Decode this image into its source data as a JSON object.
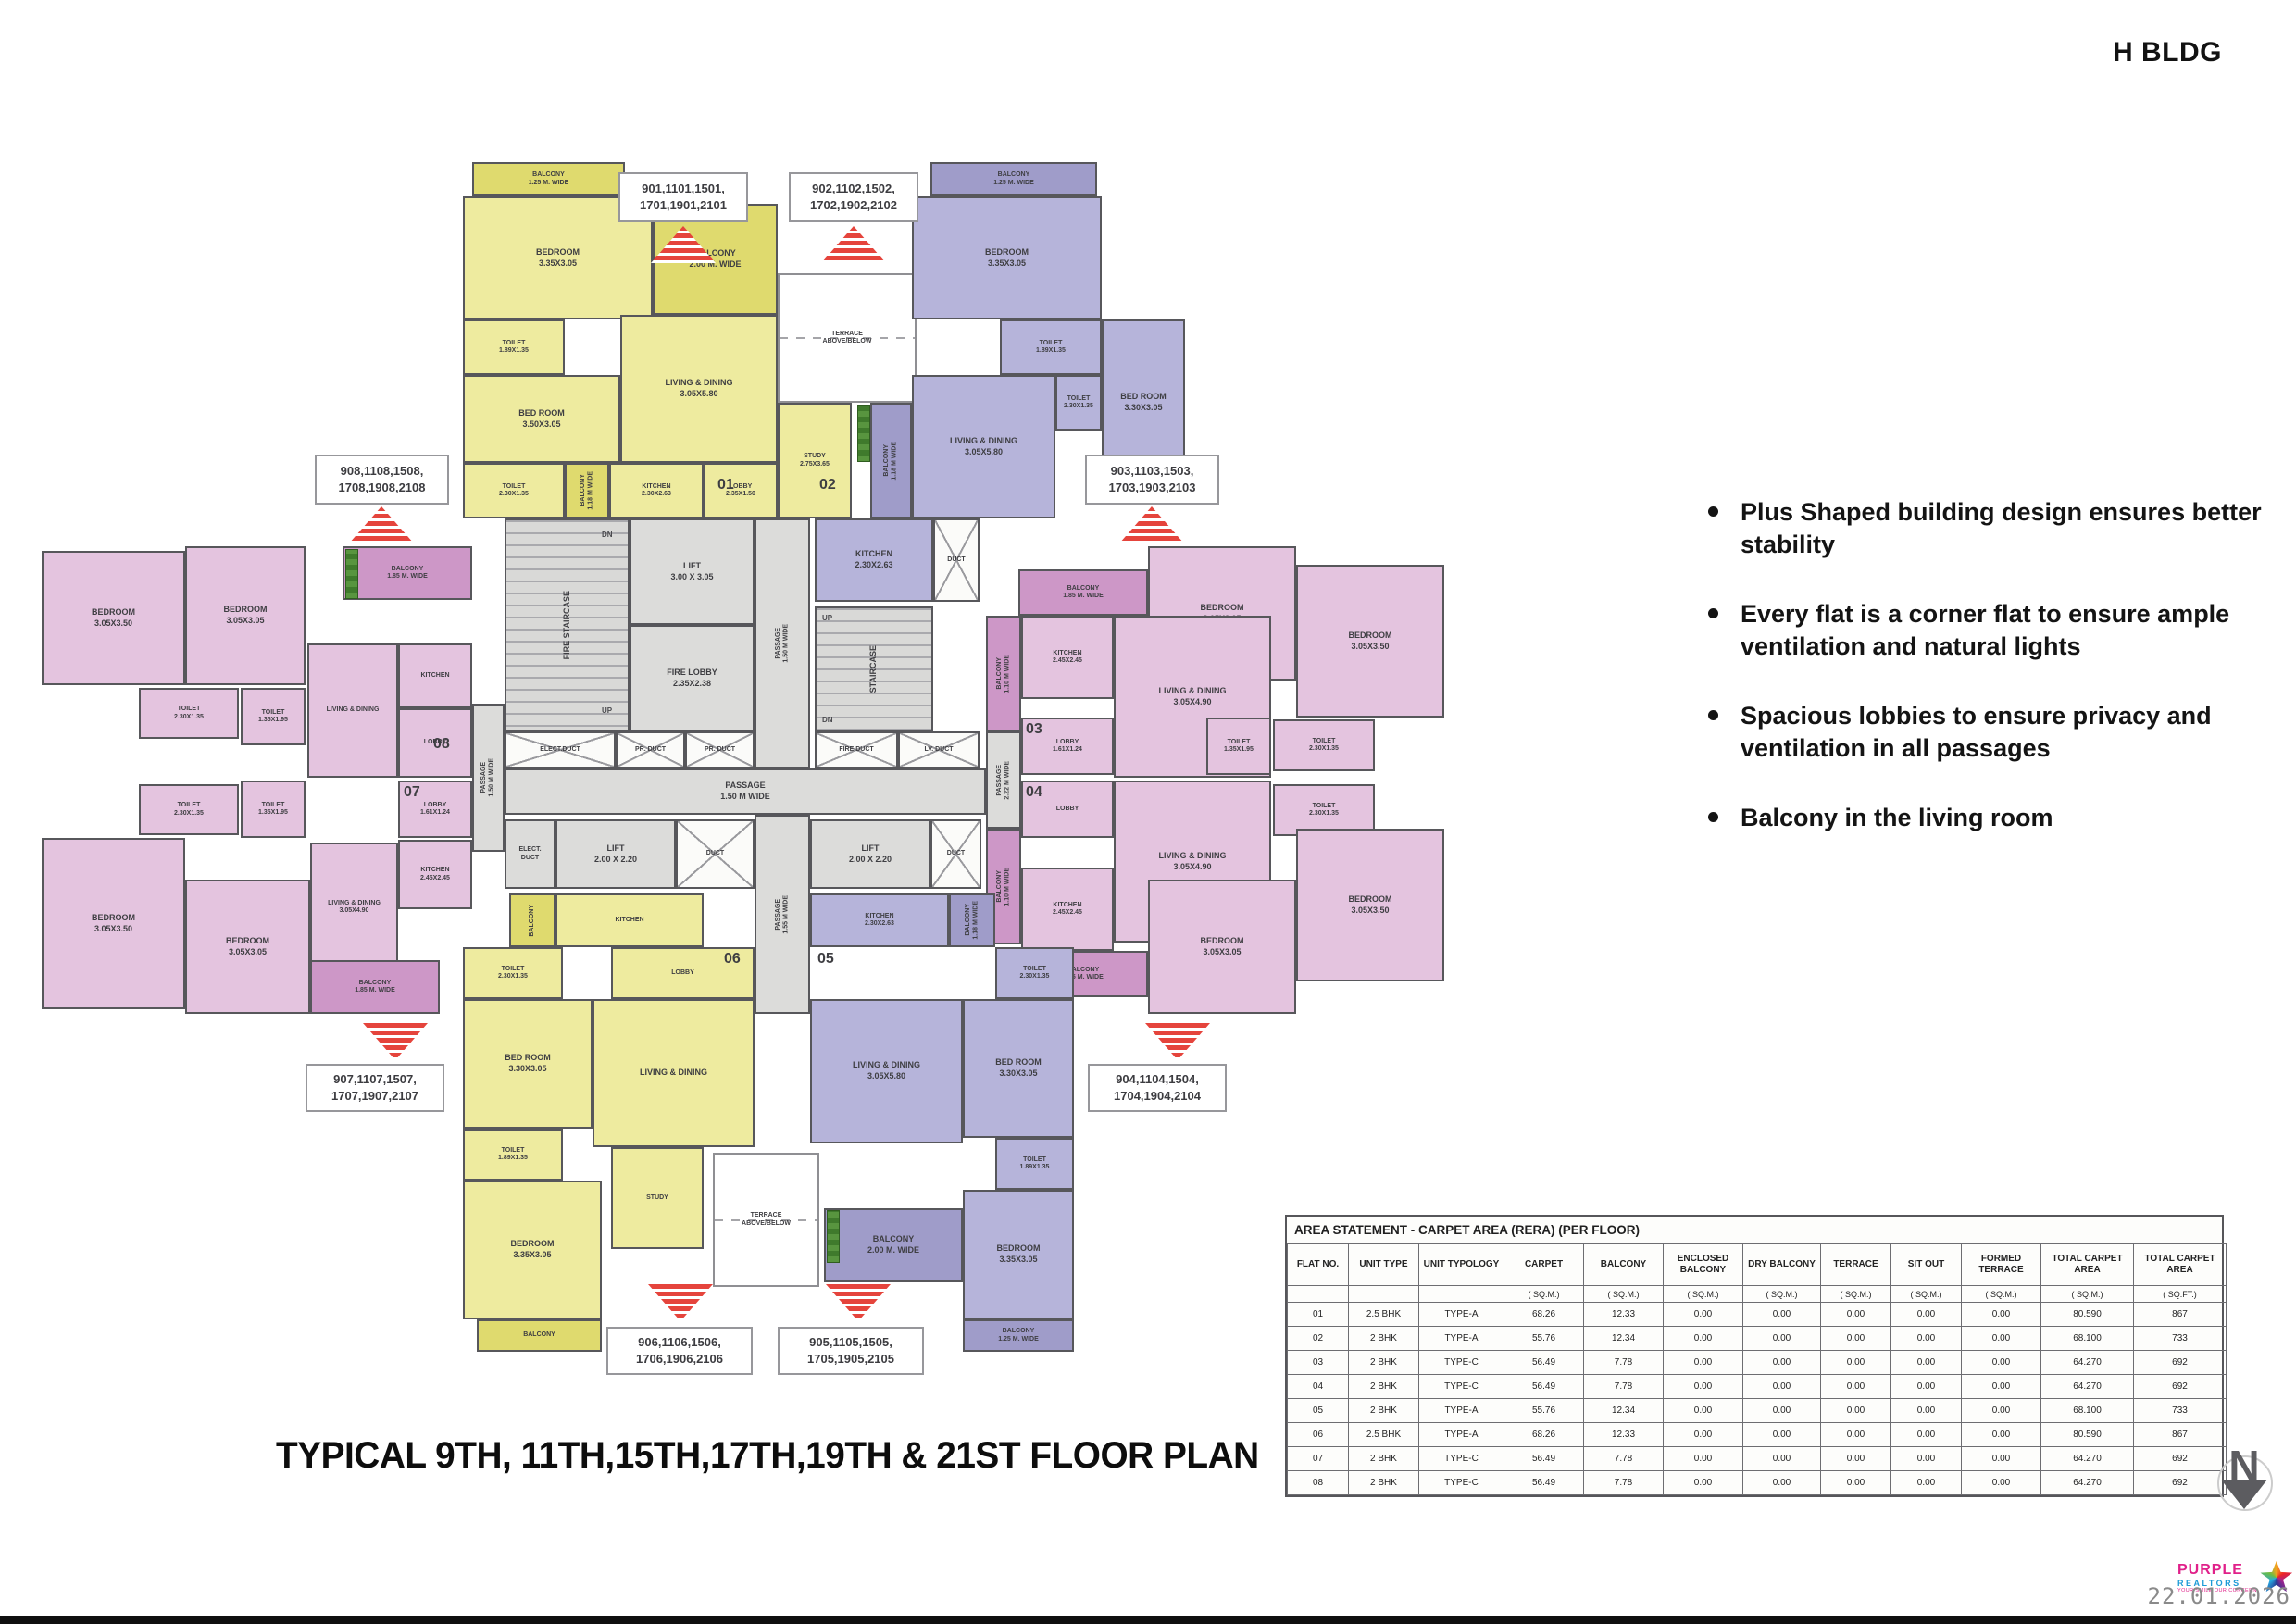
{
  "meta": {
    "building": "H BLDG"
  },
  "features": [
    "Plus Shaped building design ensures better stability",
    "Every flat is a corner flat to ensure ample ventilation and natural lights",
    "Spacious lobbies to ensure privacy and ventilation in all passages",
    "Balcony in the living room"
  ],
  "plan_title": "TYPICAL  9TH, 11TH,15TH,17TH,19TH & 21ST FLOOR PLAN",
  "callouts": {
    "u901": "901,1101,1501,\n1701,1901,2101",
    "u902": "902,1102,1502,\n1702,1902,2102",
    "u903": "903,1103,1503,\n1703,1903,2103",
    "u904": "904,1104,1504,\n1704,1904,2104",
    "u905": "905,1105,1505,\n1705,1905,2105",
    "u906": "906,1106,1506,\n1706,1906,2106",
    "u907": "907,1107,1507,\n1707,1907,2107",
    "u908": "908,1108,1508,\n1708,1908,2108"
  },
  "table": {
    "title": "AREA STATEMENT  - CARPET AREA (RERA) (PER FLOOR)",
    "columns": [
      "FLAT NO.",
      "UNIT TYPE",
      "UNIT TYPOLOGY",
      "CARPET",
      "BALCONY",
      "ENCLOSED\nBALCONY",
      "DRY BALCONY",
      "TERRACE",
      "SIT OUT",
      "FORMED\nTERRACE",
      "TOTAL CARPET\nAREA",
      "TOTAL CARPET\nAREA"
    ],
    "units": [
      "",
      "",
      "",
      "( SQ.M.)",
      "( SQ.M.)",
      "( SQ.M.)",
      "( SQ.M.)",
      "( SQ.M.)",
      "( SQ.M.)",
      "( SQ.M.)",
      "( SQ.M.)",
      "( SQ.FT.)"
    ],
    "rows": [
      [
        "01",
        "2.5 BHK",
        "TYPE-A",
        "68.26",
        "12.33",
        "0.00",
        "0.00",
        "0.00",
        "0.00",
        "0.00",
        "80.590",
        "867"
      ],
      [
        "02",
        "2 BHK",
        "TYPE-A",
        "55.76",
        "12.34",
        "0.00",
        "0.00",
        "0.00",
        "0.00",
        "0.00",
        "68.100",
        "733"
      ],
      [
        "03",
        "2 BHK",
        "TYPE-C",
        "56.49",
        "7.78",
        "0.00",
        "0.00",
        "0.00",
        "0.00",
        "0.00",
        "64.270",
        "692"
      ],
      [
        "04",
        "2 BHK",
        "TYPE-C",
        "56.49",
        "7.78",
        "0.00",
        "0.00",
        "0.00",
        "0.00",
        "0.00",
        "64.270",
        "692"
      ],
      [
        "05",
        "2 BHK",
        "TYPE-A",
        "55.76",
        "12.34",
        "0.00",
        "0.00",
        "0.00",
        "0.00",
        "0.00",
        "68.100",
        "733"
      ],
      [
        "06",
        "2.5 BHK",
        "TYPE-A",
        "68.26",
        "12.33",
        "0.00",
        "0.00",
        "0.00",
        "0.00",
        "0.00",
        "80.590",
        "867"
      ],
      [
        "07",
        "2 BHK",
        "TYPE-C",
        "56.49",
        "7.78",
        "0.00",
        "0.00",
        "0.00",
        "0.00",
        "0.00",
        "64.270",
        "692"
      ],
      [
        "08",
        "2 BHK",
        "TYPE-C",
        "56.49",
        "7.78",
        "0.00",
        "0.00",
        "0.00",
        "0.00",
        "0.00",
        "64.270",
        "692"
      ]
    ]
  },
  "plan": {
    "terrace": "TERRACE\nABOVE/BELOW",
    "core": {
      "fire_staircase": "FIRE STAIRCASE",
      "staircase": "STAIRCASE",
      "lift_main": "LIFT\n3.00 X 3.05",
      "fire_lobby": "FIRE LOBBY\n2.35X2.38",
      "passage_v_top": "PASSAGE\n1.50 M WIDE",
      "passage_v_bottom": "PASSAGE\n1.55 M WIDE",
      "passage_h": "PASSAGE\n1.50 M WIDE",
      "passage_left": "PASSAGE\n1.50 M WIDE",
      "passage_right": "PASSAGE\n2.22 M WIDE",
      "elect_duct1": "ELECT.DUCT",
      "pr_duct1": "PR. DUCT",
      "pr_duct2": "PR. DUCT",
      "fire_duct": "FIRE DUCT",
      "lv_duct": "LV. DUCT",
      "duct1": "DUCT",
      "duct2": "DUCT",
      "duct3": "DUCT",
      "elect_duct2": "ELECT.\nDUCT",
      "lift_a": "LIFT\n2.00 X 2.20",
      "lift_b": "LIFT\n2.00 X 2.20",
      "up1": "UP",
      "dn1": "DN",
      "up2": "UP",
      "dn2": "DN"
    },
    "flats": {
      "f1": {
        "num": "01",
        "balcony_top": "BALCONY\n1.25 M. WIDE",
        "bedroom1": "BEDROOM\n3.35X3.05",
        "balcony_side": "BALCONY\n2.00 M. WIDE",
        "toilet1": "TOILET\n1.89X1.35",
        "bedroom2": "BED ROOM\n3.50X3.05",
        "living": "LIVING & DINING\n3.05X5.80",
        "toilet2": "TOILET\n2.30X1.35",
        "balcony_small": "BALCONY\n1.18 M WIDE",
        "kitchen": "KITCHEN\n2.30X2.63",
        "lobby": "LOBBY\n2.35X1.50",
        "study": "STUDY\n2.75X3.65"
      },
      "f2": {
        "num": "02",
        "balcony_top": "BALCONY\n1.25 M. WIDE",
        "bedroom1": "BEDROOM\n3.35X3.05",
        "toilet1": "TOILET\n1.89X1.35",
        "bedroom2": "BED ROOM\n3.30X3.05",
        "living": "LIVING & DINING\n3.05X5.80",
        "toilet2": "TOILET\n2.30X1.35",
        "balcony_small": "BALCONY\n1.18 M WIDE",
        "kitchen": "KITCHEN\n2.30X2.63"
      },
      "f3": {
        "num": "03",
        "balcony_top": "BALCONY\n1.85 M. WIDE",
        "balcony_side": "BALCONY\n1.10 M WIDE",
        "bedroom1": "BEDROOM\n3.05X3.05",
        "bedroom2": "BEDROOM\n3.05X3.50",
        "kitchen": "KITCHEN\n2.45X2.45",
        "living": "LIVING & DINING\n3.05X4.90",
        "toilet1": "TOILET\n2.30X1.35",
        "toilet2": "TOILET\n1.35X1.95",
        "lobby": "LOBBY\n1.61X1.24"
      },
      "f4": {
        "num": "04",
        "balcony_bottom": "BALCONY\n1.85 M. WIDE",
        "balcony_side": "BALCONY\n1.10 M WIDE",
        "bedroom1": "BEDROOM\n3.05X3.05",
        "bedroom2": "BEDROOM\n3.05X3.50",
        "kitchen": "KITCHEN\n2.45X2.45",
        "living": "LIVING & DINING\n3.05X4.90",
        "toilet1": "TOILET\n2.30X1.35",
        "toilet2": "TOILET\n1.35X1.95",
        "lobby": "LOBBY"
      },
      "f5": {
        "num": "05",
        "kitchen": "KITCHEN\n2.30X2.63",
        "balcony_small": "BALCONY\n1.18 M WIDE",
        "toilet1": "TOILET\n2.30X1.35",
        "living": "LIVING & DINING\n3.05X5.80",
        "bedroom1": "BED ROOM\n3.30X3.05",
        "toilet2": "TOILET\n1.89X1.35",
        "balcony_side": "BALCONY\n2.00 M. WIDE",
        "bedroom2": "BEDROOM\n3.35X3.05",
        "balcony_bottom": "BALCONY\n1.25 M. WIDE"
      },
      "f6": {
        "num": "06",
        "kitchen": "KITCHEN",
        "balcony_small": "BALCONY",
        "toilet1": "TOILET\n2.30X1.35",
        "lobby": "LOBBY",
        "living": "LIVING & DINING",
        "study": "STUDY",
        "bedroom1": "BED ROOM\n3.30X3.05",
        "toilet2": "TOILET\n1.89X1.35",
        "bedroom2": "BEDROOM\n3.35X3.05",
        "balcony_bottom": "BALCONY"
      },
      "f7": {
        "num": "07",
        "lobby": "LOBBY\n1.61X1.24",
        "toilet1": "TOILET\n2.30X1.35",
        "toilet2": "TOILET\n1.35X1.95",
        "kitchen": "KITCHEN\n2.45X2.45",
        "living": "LIVING & DINING\n3.05X4.90",
        "bedroom1": "BEDROOM\n3.05X3.50",
        "bedroom2": "BEDROOM\n3.05X3.05",
        "balcony_bottom": "BALCONY\n1.85 M. WIDE"
      },
      "f8": {
        "num": "08",
        "bedroom1": "BEDROOM\n3.05X3.50",
        "bedroom2": "BEDROOM\n3.05X3.05",
        "balcony_top": "BALCONY\n1.85 M. WIDE",
        "toilet1": "TOILET\n2.30X1.35",
        "toilet2": "TOILET\n1.35X1.95",
        "living": "LIVING & DINING",
        "kitchen": "KITCHEN",
        "lobby": "LOBBY"
      }
    }
  },
  "north_label": "N",
  "footer": {
    "logo_line1": "PURPLE",
    "logo_line2": "REALTORS",
    "logo_tagline": "YOUR SMILE OUR CONCERN",
    "date": "22.01.2026"
  },
  "colors": {
    "flat_yellow": "#eeeb9f",
    "flat_yellow_balcony": "#dfda6e",
    "flat_purple": "#b6b4da",
    "flat_purple_balcony": "#9f9cc9",
    "flat_pink": "#e4c4df",
    "flat_pink_balcony": "#cd97c7",
    "core_gray": "#dcdcda",
    "wall": "#57575b",
    "marker_red": "#e5443c"
  }
}
